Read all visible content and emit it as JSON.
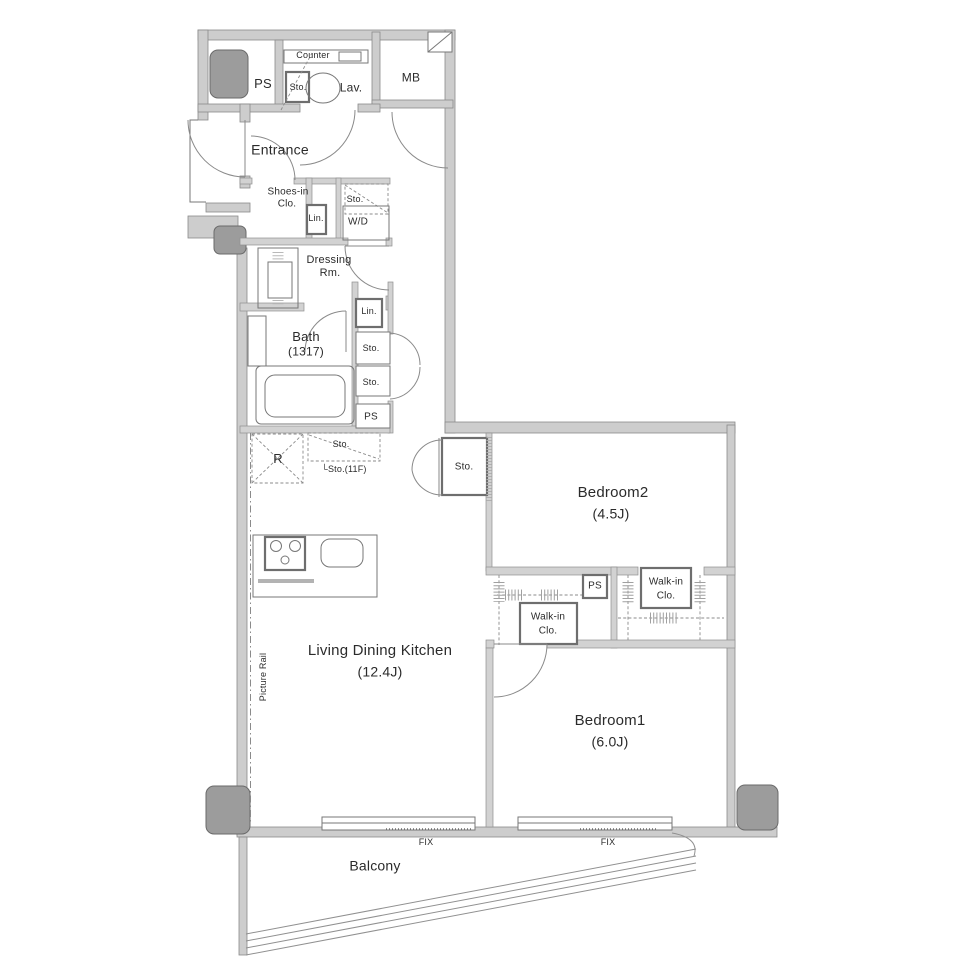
{
  "plan_type": "apartment-floor-plan",
  "labels": {
    "ps_top": "PS",
    "counter": "Counter",
    "sto_lav": "Sto.",
    "lav": "Lav.",
    "mb": "MB",
    "entrance": "Entrance",
    "shoes_l1": "Shoes-in",
    "shoes_l2": "Clo.",
    "lin_entrance": "Lin.",
    "sto_wd": "Sto.",
    "wd": "W/D",
    "dressing_l1": "Dressing",
    "dressing_l2": "Rm.",
    "bath": "Bath",
    "bath_size": "(1317)",
    "lin_bath": "Lin.",
    "sto_upper": "Sto.",
    "sto_lower": "Sto.",
    "ps_mid": "PS",
    "fridge": "R",
    "sto_shelf": "Sto.",
    "sto_shelf_11f": "└Sto.(11F)",
    "sto_hall": "Sto.",
    "bedroom2": "Bedroom2",
    "bedroom2_size": "(4.5J)",
    "ps_closet": "PS",
    "walkin_right_l1": "Walk-in",
    "walkin_right_l2": "Clo.",
    "walkin_left_l1": "Walk-in",
    "walkin_left_l2": "Clo.",
    "ldk": "Living Dining Kitchen",
    "ldk_size": "(12.4J)",
    "picture_rail": "Picture Rail",
    "bedroom1": "Bedroom1",
    "bedroom1_size": "(6.0J)",
    "fix_left": "FIX",
    "fix_right": "FIX",
    "balcony": "Balcony"
  },
  "colors": {
    "background": "#ffffff",
    "wall_fill": "#cdcdcd",
    "wall_stroke": "#8a8a8a",
    "pillar_fill": "#9c9c9c",
    "line": "#777777",
    "text": "#2b2b2b"
  }
}
